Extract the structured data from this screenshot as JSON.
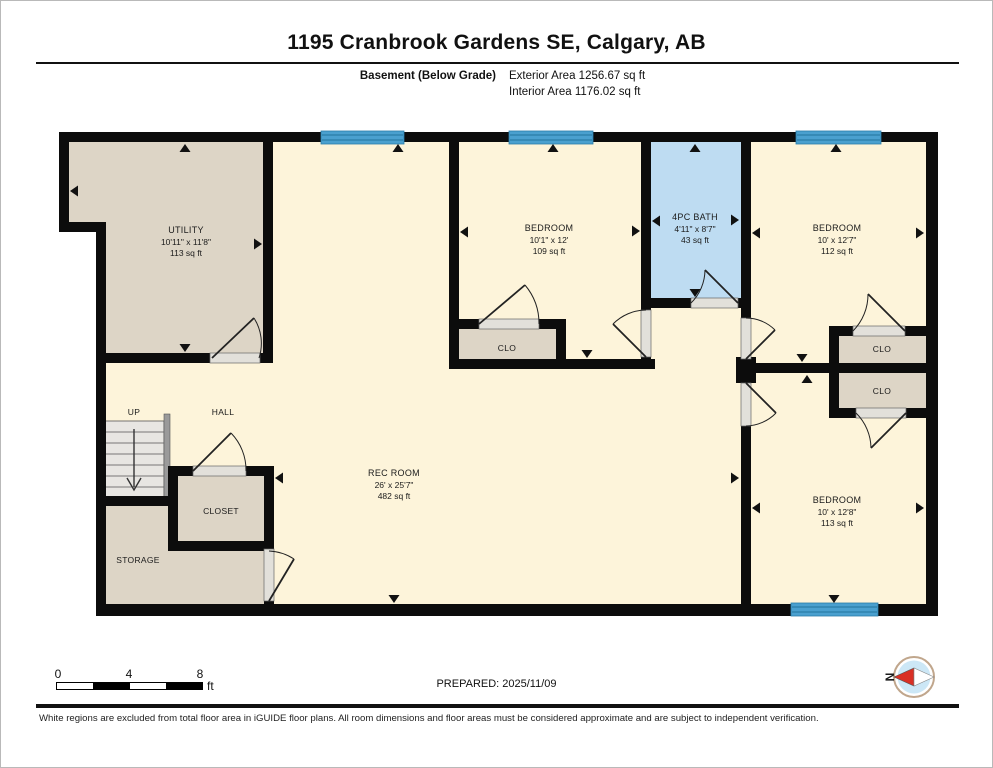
{
  "header": {
    "address": "1195 Cranbrook Gardens SE, Calgary, AB",
    "floor_label": "Basement (Below Grade)",
    "exterior_area": "Exterior Area 1256.67 sq ft",
    "interior_area": "Interior Area 1176.02 sq ft"
  },
  "plan": {
    "rooms": {
      "utility": {
        "name": "UTILITY",
        "dims": "10'11\" x 11'8\"",
        "area": "113 sq ft"
      },
      "bedroom_top": {
        "name": "BEDROOM",
        "dims": "10'1\" x 12'",
        "area": "109 sq ft"
      },
      "bath": {
        "name": "4PC BATH",
        "dims": "4'11\" x 8'7\"",
        "area": "43 sq ft"
      },
      "bedroom_right_top": {
        "name": "BEDROOM",
        "dims": "10' x 12'7\"",
        "area": "112 sq ft"
      },
      "bedroom_right_bottom": {
        "name": "BEDROOM",
        "dims": "10' x 12'8\"",
        "area": "113 sq ft"
      },
      "rec_room": {
        "name": "REC ROOM",
        "dims": "26' x 25'7\"",
        "area": "482 sq ft"
      }
    },
    "labels": {
      "clo_bedroom_top": "CLO",
      "clo_right_top": "CLO",
      "clo_right_bottom": "CLO",
      "closet": "CLOSET",
      "storage": "STORAGE",
      "up": "UP",
      "hall": "HALL"
    },
    "colors": {
      "wall": "#0c0c0c",
      "floor": "#fdf4da",
      "room": "#ddd5c6",
      "bath": "#bedcf2",
      "window": "#4aa0cf",
      "windowline": "#2a7ca8",
      "door": "#e2e0da",
      "compass_red": "#d93025",
      "compass_fill": "#cce7f6",
      "compass_ring": "#c0a68c"
    }
  },
  "footer": {
    "scale": {
      "tick_0": "0",
      "tick_4": "4",
      "tick_8": "8",
      "unit": "ft"
    },
    "prepared": "PREPARED: 2025/11/09",
    "compass_label": "N",
    "disclaimer": "White regions are excluded from total floor area in iGUIDE floor plans. All room dimensions and floor areas must be considered approximate and are subject to independent verification."
  }
}
